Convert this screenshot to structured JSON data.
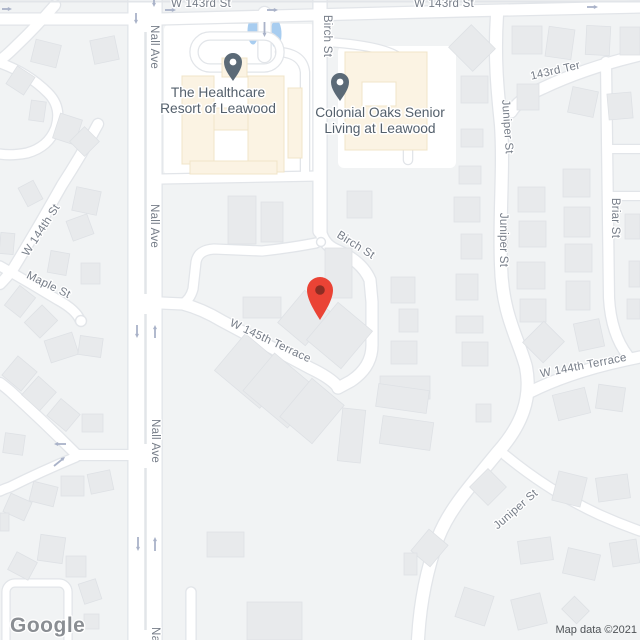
{
  "streets": [
    "W 143rd St",
    "W 143rd St",
    "Nall Ave",
    "Nall Ave",
    "Nall Ave",
    "Nall Ave",
    "Birch St",
    "Birch St",
    "W 145th Terrace",
    "W 144th St",
    "Maple St",
    "143rd Ter",
    "Juniper St",
    "Juniper St",
    "Juniper St",
    "Briar St",
    "W 144th Terrace"
  ],
  "pois": [
    {
      "name": "The Healthcare Resort of Leawood",
      "lines": [
        "The Healthcare",
        "Resort of Leawood"
      ]
    },
    {
      "name": "Colonial Oaks Senior Living at Leawood",
      "lines": [
        "Colonial Oaks Senior",
        "Living at Leawood"
      ]
    }
  ],
  "attribution": {
    "logo_text": "Google",
    "map_data_text": "Map data ©2021"
  },
  "colors": {
    "land": "#f1f3f4",
    "road_fill": "#ffffff",
    "road_casing": "#e2e5e9",
    "building_fill": "#e8eaec",
    "building_stroke": "#dee1e5",
    "poi_area_fill": "#fbf3e3",
    "poi_area_stroke": "#f0e4c8",
    "water_blue": "#a8cdf0",
    "marker_red": "#ea4335",
    "marker_dot": "#8c2d23",
    "poi_pin": "#5b6a77",
    "street_label": "#767d88",
    "poi_label": "#54606c",
    "arrow": "#a9b2c8"
  }
}
